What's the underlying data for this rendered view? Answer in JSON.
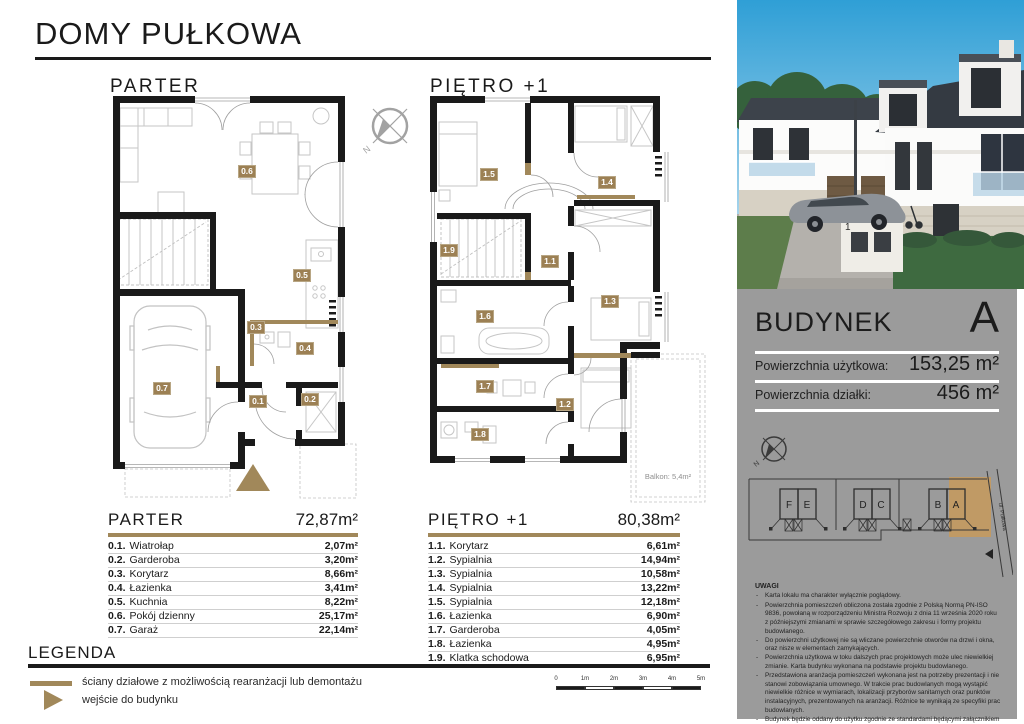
{
  "header": {
    "title": "DOMY PUŁKOWA"
  },
  "plans": {
    "parter": {
      "title": "PARTER",
      "room_labels": [
        "0.1",
        "0.2",
        "0.3",
        "0.4",
        "0.5",
        "0.6",
        "0.7"
      ]
    },
    "pietro": {
      "title": "PIĘTRO +1",
      "room_labels": [
        "1.1",
        "1.2",
        "1.3",
        "1.4",
        "1.5",
        "1.6",
        "1.7",
        "1.8",
        "1.9"
      ],
      "balcony_label": "Balkon: 5,4m²"
    }
  },
  "compass": {
    "north_label": "N"
  },
  "tables": {
    "parter": {
      "title": "PARTER",
      "total": "72,87m²",
      "rows": [
        {
          "no": "0.1.",
          "name": "Wiatrołap",
          "area": "2,07m²"
        },
        {
          "no": "0.2.",
          "name": "Garderoba",
          "area": "3,20m²"
        },
        {
          "no": "0.3.",
          "name": "Korytarz",
          "area": "8,66m²"
        },
        {
          "no": "0.4.",
          "name": "Łazienka",
          "area": "3,41m²"
        },
        {
          "no": "0.5.",
          "name": "Kuchnia",
          "area": "8,22m²"
        },
        {
          "no": "0.6.",
          "name": "Pokój dzienny",
          "area": "25,17m²"
        },
        {
          "no": "0.7.",
          "name": "Garaż",
          "area": "22,14m²"
        }
      ]
    },
    "pietro": {
      "title": "PIĘTRO +1",
      "total": "80,38m²",
      "rows": [
        {
          "no": "1.1.",
          "name": "Korytarz",
          "area": "6,61m²"
        },
        {
          "no": "1.2.",
          "name": "Sypialnia",
          "area": "14,94m²"
        },
        {
          "no": "1.3.",
          "name": "Sypialnia",
          "area": "10,58m²"
        },
        {
          "no": "1.4.",
          "name": "Sypialnia",
          "area": "13,22m²"
        },
        {
          "no": "1.5.",
          "name": "Sypialnia",
          "area": "12,18m²"
        },
        {
          "no": "1.6.",
          "name": "Łazienka",
          "area": "6,90m²"
        },
        {
          "no": "1.7.",
          "name": "Garderoba",
          "area": "4,05m²"
        },
        {
          "no": "1.8.",
          "name": "Łazienka",
          "area": "4,95m²"
        },
        {
          "no": "1.9.",
          "name": "Klatka schodowa",
          "area": "6,95m²"
        }
      ]
    }
  },
  "legend": {
    "title": "LEGENDA",
    "items": [
      "ściany działowe z możliwością rearanżacji lub demontażu",
      "wejście do budynku"
    ]
  },
  "scale_bar": {
    "ticks": [
      "0",
      "1m",
      "2m",
      "3m",
      "4m",
      "5m"
    ]
  },
  "sidebar": {
    "building_card": {
      "title": "BUDYNEK",
      "letter": "A",
      "rows": [
        {
          "label": "Powierzchnia użytkowa:",
          "value": "153,25 m²"
        },
        {
          "label": "Powierzchnia działki:",
          "value": "456 m²"
        }
      ]
    },
    "site_plan": {
      "buildings": [
        "F",
        "E",
        "D",
        "C",
        "B",
        "A"
      ],
      "street": "ul. Pułkowa",
      "highlighted_building": "A"
    },
    "render": {
      "sign_number": "1"
    },
    "uwagi": {
      "title": "UWAGI",
      "items": [
        "Karta lokalu ma charakter wyłącznie poglądowy.",
        "Powierzchnia pomieszczeń obliczona została zgodnie z Polską Normą PN-ISO 9836, powołaną w rozporządzeniu Ministra Rozwoju z dnia 11 września 2020 roku z późniejszymi zmianami w sprawie szczegółowego zakresu i formy projektu budowlanego.",
        "Do powierzchni użytkowej nie są wliczane powierzchnie otworów na drzwi i okna, oraz nisze w elementach zamykających.",
        "Powierzchnia użytkowa w toku dalszych prac projektowych może ulec niewielkiej zmianie. Karta budynku wykonana na podstawie projektu budowlanego.",
        "Przedstawiona aranżacja pomieszczeń wykonana jest na potrzeby prezentacji i nie stanowi zobowiązania umownego. W trakcie prac budowlanych mogą wystąpić niewielkie różnice w wymiarach, lokalizacji przyborów sanitarnych oraz punktów instalacyjnych, prezentowanych na aranżacji. Różnice te wynikają ze specyfiki prac budowlanych.",
        "Budynek będzie oddany do użytku zgodnie ze standardami będącymi załącznikiem do umowy deweloperskiej.",
        "Naruszanie elementów konstrukcyjnych jest zabronione."
      ]
    }
  },
  "colors": {
    "accent_brown": "#a1885a",
    "room_label_brown": "#9c8054",
    "panel_gray": "#9b9b9b",
    "wall_black": "#1a1a1a",
    "sky_blue": "#2f9fd6",
    "site_highlight": "#c49a5f"
  }
}
